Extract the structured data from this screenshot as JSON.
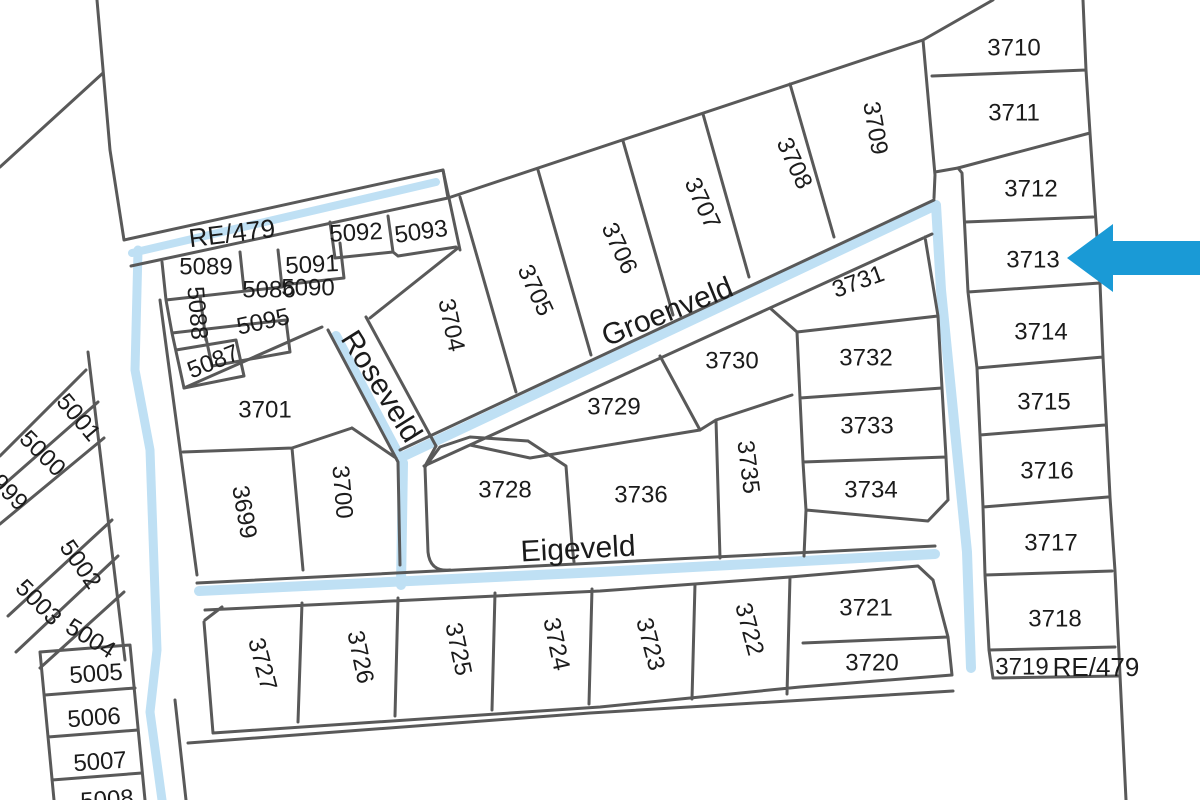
{
  "map": {
    "title": "Cadastral parcel map",
    "colors": {
      "background": "#ffffff",
      "boundary_line": "#595959",
      "water_line": "#bfe0f4",
      "arrow": "#1a9ad6",
      "text": "#1b1b1b"
    },
    "arrow": {
      "target_parcel": "3713"
    },
    "streets": [
      {
        "name": "Groenveld",
        "x": 667,
        "y": 311,
        "r": -22,
        "size": 30
      },
      {
        "name": "Roseveld",
        "x": 382,
        "y": 386,
        "r": 58,
        "size": 30
      },
      {
        "name": "Eigeveld",
        "x": 578,
        "y": 548,
        "r": -3,
        "size": 31
      }
    ],
    "annotations": [
      {
        "t": "RE/479",
        "x": 232,
        "y": 233,
        "r": -7,
        "size": 27
      },
      {
        "t": "RE/479",
        "x": 1096,
        "y": 667,
        "r": 0,
        "size": 24
      }
    ],
    "parcel_labels": [
      {
        "t": "3710",
        "x": 1014,
        "y": 47,
        "r": 0
      },
      {
        "t": "3711",
        "x": 1014,
        "y": 112,
        "r": 0
      },
      {
        "t": "3712",
        "x": 1031,
        "y": 188,
        "r": 0
      },
      {
        "t": "3713",
        "x": 1033,
        "y": 259,
        "r": 0
      },
      {
        "t": "3714",
        "x": 1041,
        "y": 331,
        "r": 0
      },
      {
        "t": "3715",
        "x": 1044,
        "y": 401,
        "r": 0
      },
      {
        "t": "3716",
        "x": 1047,
        "y": 470,
        "r": 0
      },
      {
        "t": "3717",
        "x": 1051,
        "y": 542,
        "r": 0
      },
      {
        "t": "3718",
        "x": 1055,
        "y": 618,
        "r": 0
      },
      {
        "t": "3719",
        "x": 1022,
        "y": 666,
        "r": 0
      },
      {
        "t": "3709",
        "x": 876,
        "y": 128,
        "r": 80
      },
      {
        "t": "3708",
        "x": 795,
        "y": 163,
        "r": 65
      },
      {
        "t": "3707",
        "x": 703,
        "y": 203,
        "r": 65
      },
      {
        "t": "3706",
        "x": 620,
        "y": 248,
        "r": 65
      },
      {
        "t": "3705",
        "x": 536,
        "y": 290,
        "r": 65
      },
      {
        "t": "3704",
        "x": 452,
        "y": 325,
        "r": 78
      },
      {
        "t": "5093",
        "x": 421,
        "y": 231,
        "r": -8
      },
      {
        "t": "5092",
        "x": 356,
        "y": 232,
        "r": -3
      },
      {
        "t": "5091",
        "x": 312,
        "y": 264,
        "r": -3
      },
      {
        "t": "5089",
        "x": 206,
        "y": 266,
        "r": 0
      },
      {
        "t": "5086",
        "x": 269,
        "y": 289,
        "r": 0
      },
      {
        "t": "5090",
        "x": 308,
        "y": 287,
        "r": 0
      },
      {
        "t": "5088",
        "x": 198,
        "y": 313,
        "r": 85
      },
      {
        "t": "5095",
        "x": 263,
        "y": 321,
        "r": -12
      },
      {
        "t": "5087",
        "x": 213,
        "y": 361,
        "r": -22
      },
      {
        "t": "3701",
        "x": 265,
        "y": 409,
        "r": 0
      },
      {
        "t": "3699",
        "x": 245,
        "y": 512,
        "r": 80
      },
      {
        "t": "3700",
        "x": 343,
        "y": 492,
        "r": 85
      },
      {
        "t": "3728",
        "x": 505,
        "y": 489,
        "r": 0
      },
      {
        "t": "3729",
        "x": 614,
        "y": 406,
        "r": 0
      },
      {
        "t": "3736",
        "x": 641,
        "y": 494,
        "r": 0
      },
      {
        "t": "3730",
        "x": 732,
        "y": 360,
        "r": 0
      },
      {
        "t": "3731",
        "x": 858,
        "y": 281,
        "r": -20
      },
      {
        "t": "3732",
        "x": 866,
        "y": 357,
        "r": 0
      },
      {
        "t": "3733",
        "x": 867,
        "y": 425,
        "r": 0
      },
      {
        "t": "3734",
        "x": 871,
        "y": 489,
        "r": 0
      },
      {
        "t": "3735",
        "x": 749,
        "y": 467,
        "r": 83
      },
      {
        "t": "3721",
        "x": 866,
        "y": 607,
        "r": 0
      },
      {
        "t": "3720",
        "x": 872,
        "y": 662,
        "r": 0
      },
      {
        "t": "3722",
        "x": 750,
        "y": 629,
        "r": 75
      },
      {
        "t": "3723",
        "x": 651,
        "y": 644,
        "r": 75
      },
      {
        "t": "3724",
        "x": 557,
        "y": 644,
        "r": 78
      },
      {
        "t": "3725",
        "x": 459,
        "y": 649,
        "r": 78
      },
      {
        "t": "3726",
        "x": 361,
        "y": 657,
        "r": 78
      },
      {
        "t": "3727",
        "x": 263,
        "y": 664,
        "r": 75
      },
      {
        "t": "5001",
        "x": 79,
        "y": 417,
        "r": 50
      },
      {
        "t": "5000",
        "x": 43,
        "y": 453,
        "r": 45
      },
      {
        "t": "999",
        "x": 10,
        "y": 492,
        "r": 45
      },
      {
        "t": "5002",
        "x": 81,
        "y": 564,
        "r": 55
      },
      {
        "t": "5003",
        "x": 39,
        "y": 602,
        "r": 45
      },
      {
        "t": "5004",
        "x": 91,
        "y": 638,
        "r": 32
      },
      {
        "t": "5005",
        "x": 96,
        "y": 673,
        "r": -4
      },
      {
        "t": "5006",
        "x": 94,
        "y": 717,
        "r": -4
      },
      {
        "t": "5007",
        "x": 100,
        "y": 761,
        "r": -4
      },
      {
        "t": "5008",
        "x": 107,
        "y": 799,
        "r": -4
      }
    ]
  }
}
